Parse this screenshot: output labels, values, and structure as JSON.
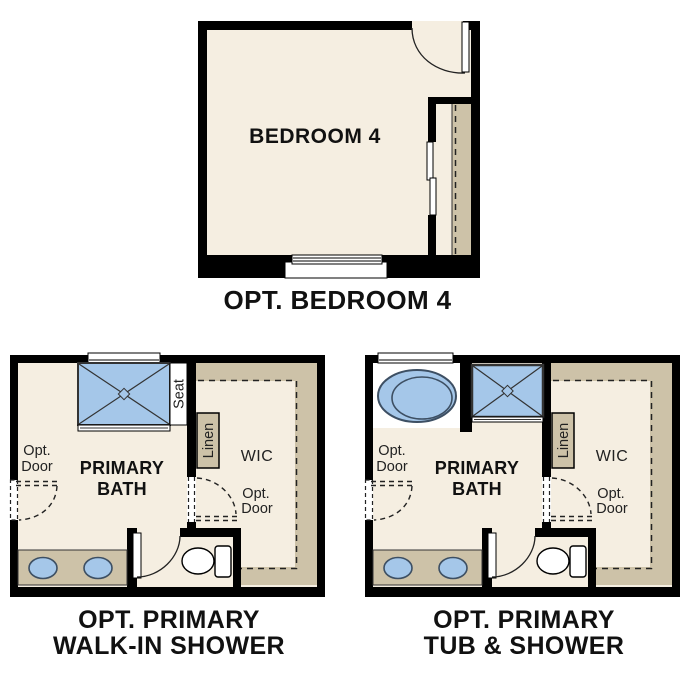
{
  "colors": {
    "background": "#FFFFFF",
    "wall": "#000000",
    "floor": "#F5EEE1",
    "shelf_tan": "#CDC2A8",
    "fixture_blue": "#A5C7E9",
    "fixture_outline": "#3D4F63"
  },
  "plans": {
    "bedroom": {
      "title": "OPT. BEDROOM 4",
      "room_label": "BEDROOM 4"
    },
    "walk_in_shower": {
      "title_line1": "OPT. PRIMARY",
      "title_line2": "WALK-IN SHOWER",
      "room_line1": "PRIMARY",
      "room_line2": "BATH",
      "seat": "Seat",
      "linen": "Linen",
      "wic": "WIC",
      "opt_door_left_line1": "Opt.",
      "opt_door_left_line2": "Door",
      "opt_door_right_line1": "Opt.",
      "opt_door_right_line2": "Door"
    },
    "tub_shower": {
      "title_line1": "OPT. PRIMARY",
      "title_line2": "TUB & SHOWER",
      "room_line1": "PRIMARY",
      "room_line2": "BATH",
      "linen": "Linen",
      "wic": "WIC",
      "opt_door_left_line1": "Opt.",
      "opt_door_left_line2": "Door",
      "opt_door_right_line1": "Opt.",
      "opt_door_right_line2": "Door"
    }
  }
}
